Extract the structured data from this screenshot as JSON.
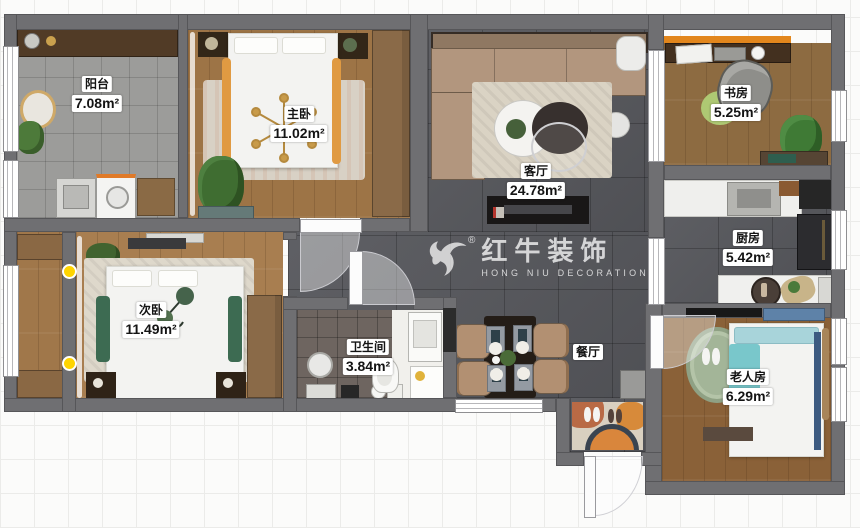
{
  "watermark": {
    "brand": "红牛装饰",
    "subtitle": "HONG NIU DECORATION",
    "registered": "®"
  },
  "rooms": [
    {
      "id": "balcony",
      "name": "阳台",
      "area": "7.08m²"
    },
    {
      "id": "master-bedroom",
      "name": "主卧",
      "area": "11.02m²"
    },
    {
      "id": "living-room",
      "name": "客厅",
      "area": "24.78m²"
    },
    {
      "id": "study",
      "name": "书房",
      "area": "5.25m²"
    },
    {
      "id": "kitchen",
      "name": "厨房",
      "area": "5.42m²"
    },
    {
      "id": "second-bedroom",
      "name": "次卧",
      "area": "11.49m²"
    },
    {
      "id": "bathroom",
      "name": "卫生间",
      "area": "3.84m²"
    },
    {
      "id": "dining-room",
      "name": "餐厅",
      "area": ""
    },
    {
      "id": "elderly-room",
      "name": "老人房",
      "area": "6.29m²"
    }
  ],
  "colors": {
    "wall": "#6f6f72",
    "dark_tile": "#56575c",
    "balcony_tile": "#9c9c9a",
    "wood": "#9d7446",
    "accent_orange": "#e2861c",
    "marker_yellow": "#ffd400",
    "sofa_tan": "#b2967e",
    "bed_white": "#f3f3f1",
    "elder_teal": "#79c7cb"
  }
}
